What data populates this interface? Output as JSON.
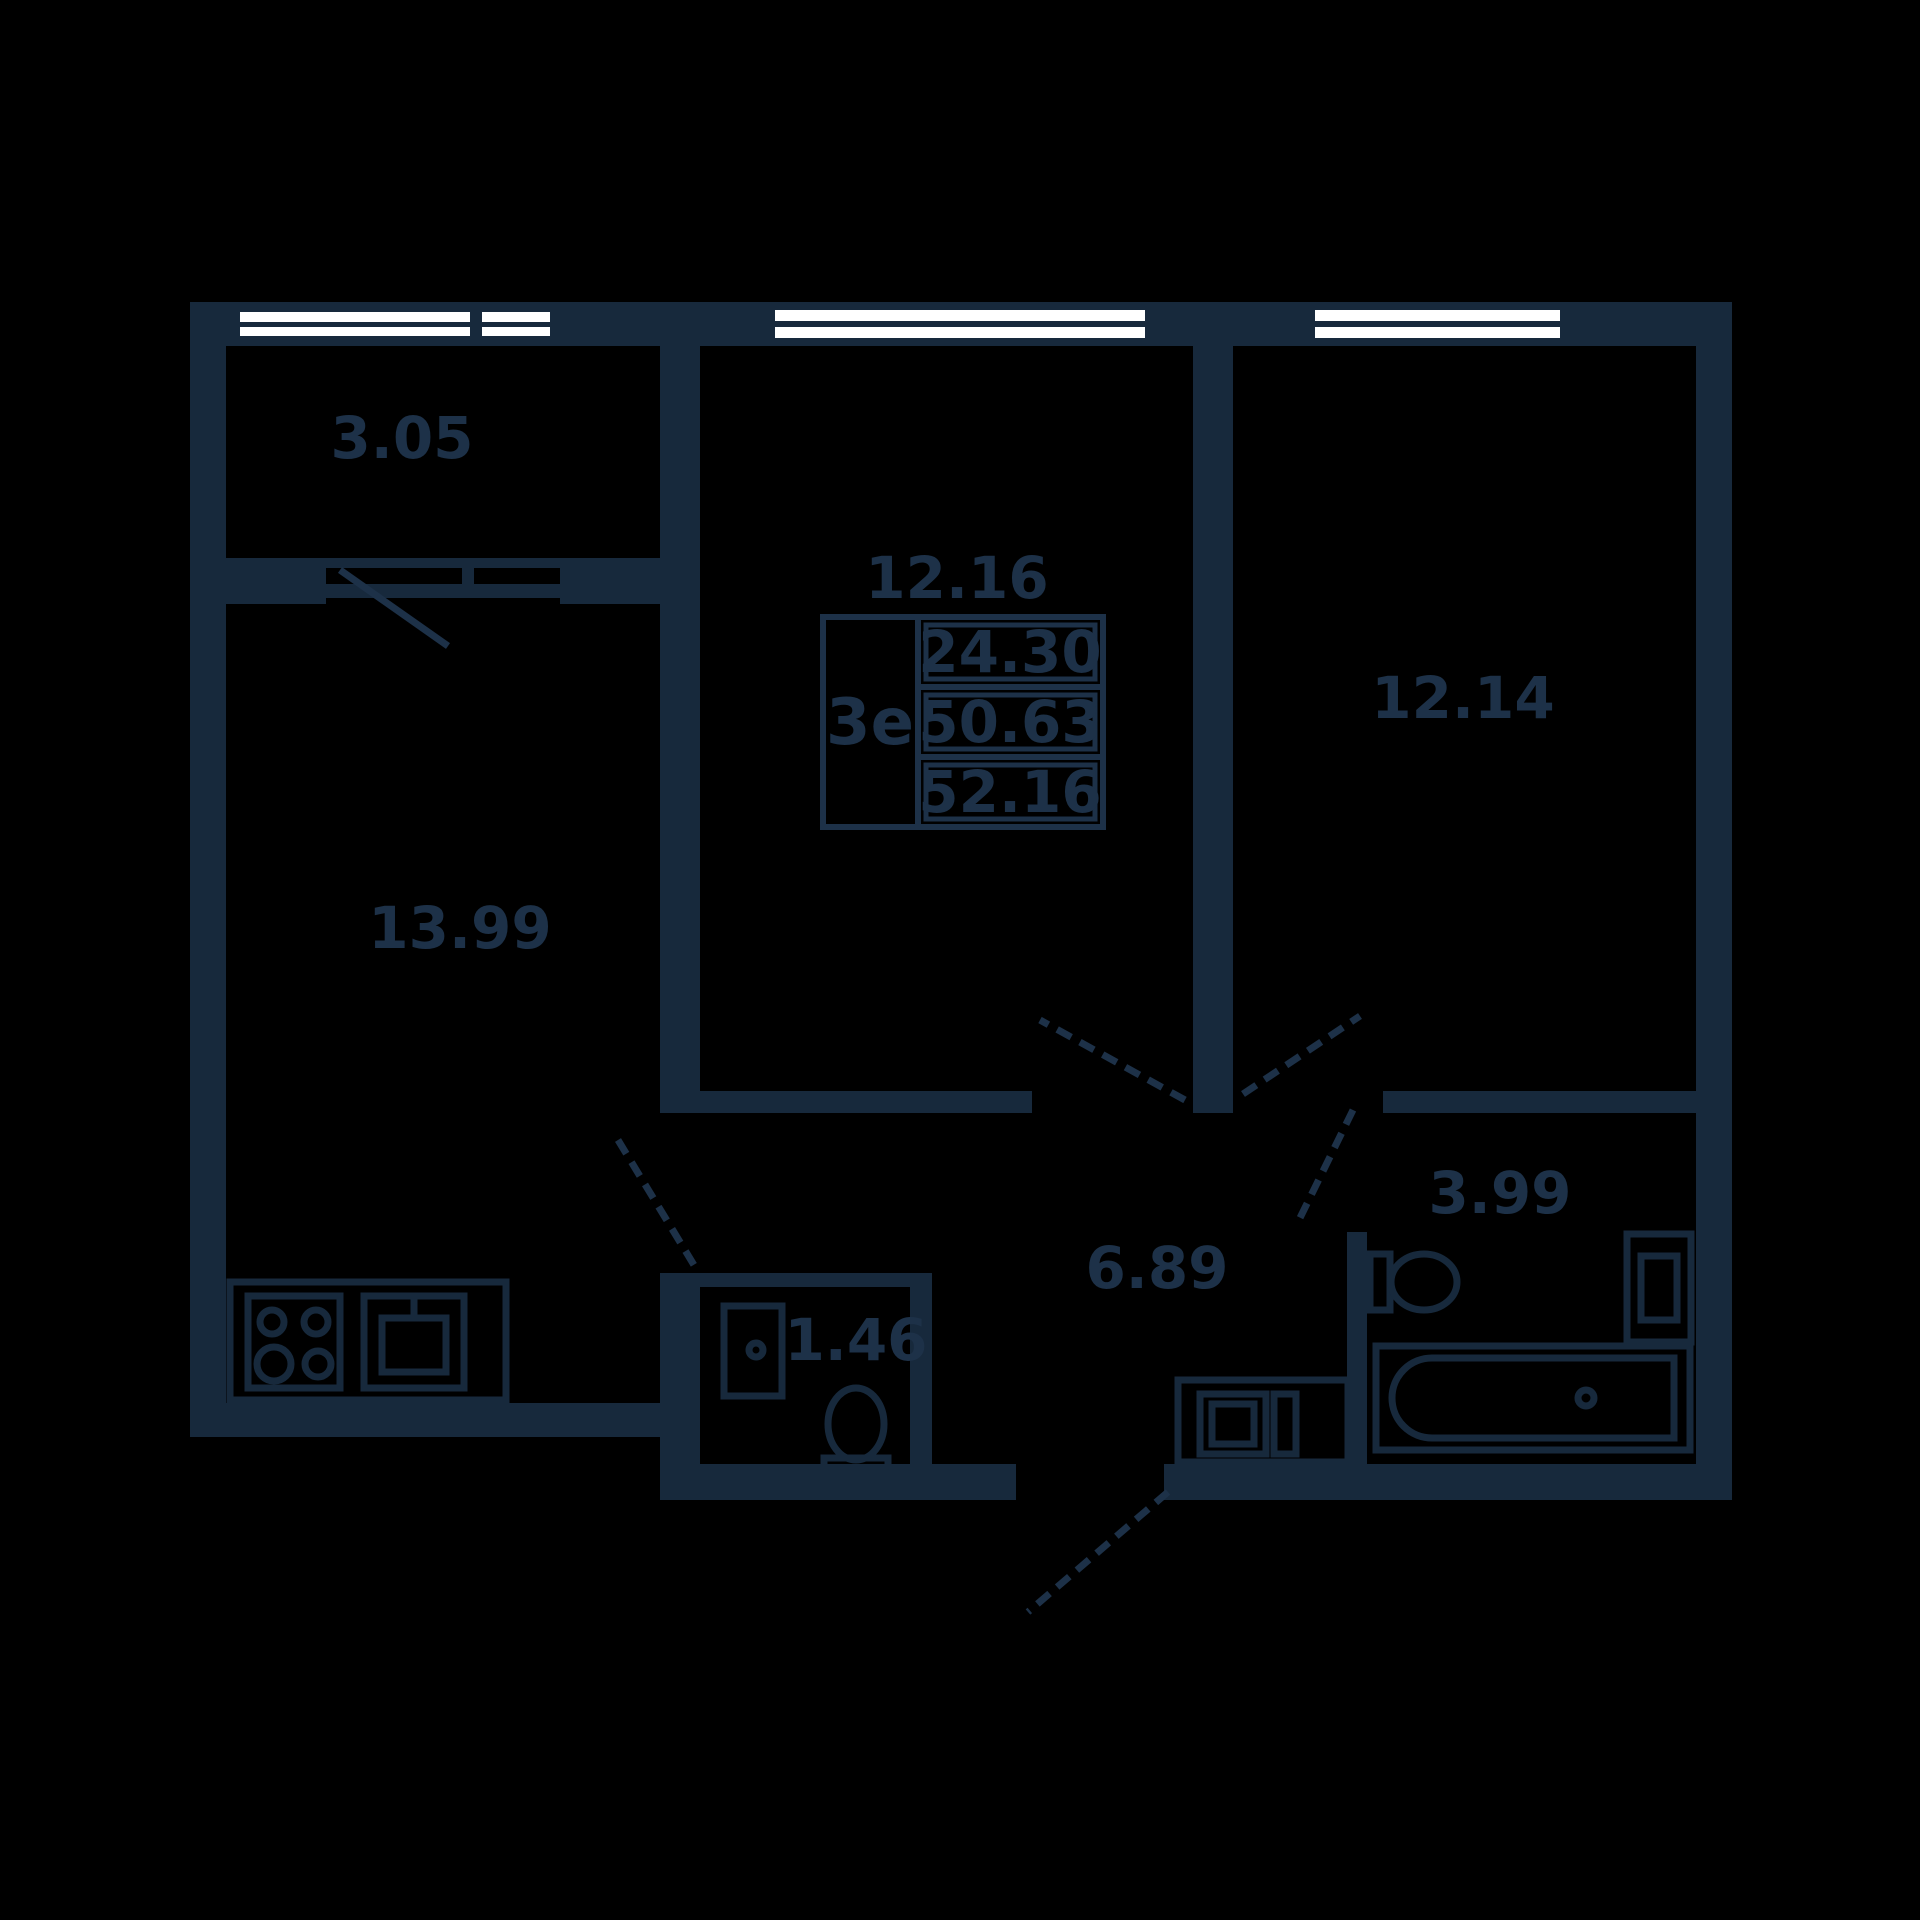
{
  "plan": {
    "kind": "apartment-floor-plan",
    "colors": {
      "background": "#000000",
      "walls": "#17293c",
      "text": "#1d3148",
      "window_glass": "#ffffff"
    },
    "rooms": [
      {
        "id": "balcony",
        "area": "3.05"
      },
      {
        "id": "kitchen-living",
        "area": "13.99"
      },
      {
        "id": "bedroom-1",
        "area": "12.16"
      },
      {
        "id": "bedroom-2",
        "area": "12.14"
      },
      {
        "id": "hallway",
        "area": "6.89"
      },
      {
        "id": "bathroom",
        "area": "3.99"
      },
      {
        "id": "wc",
        "area": "1.46"
      }
    ],
    "info_table": {
      "type_label": "3е",
      "values": [
        "24.30",
        "50.63",
        "52.16"
      ]
    }
  }
}
